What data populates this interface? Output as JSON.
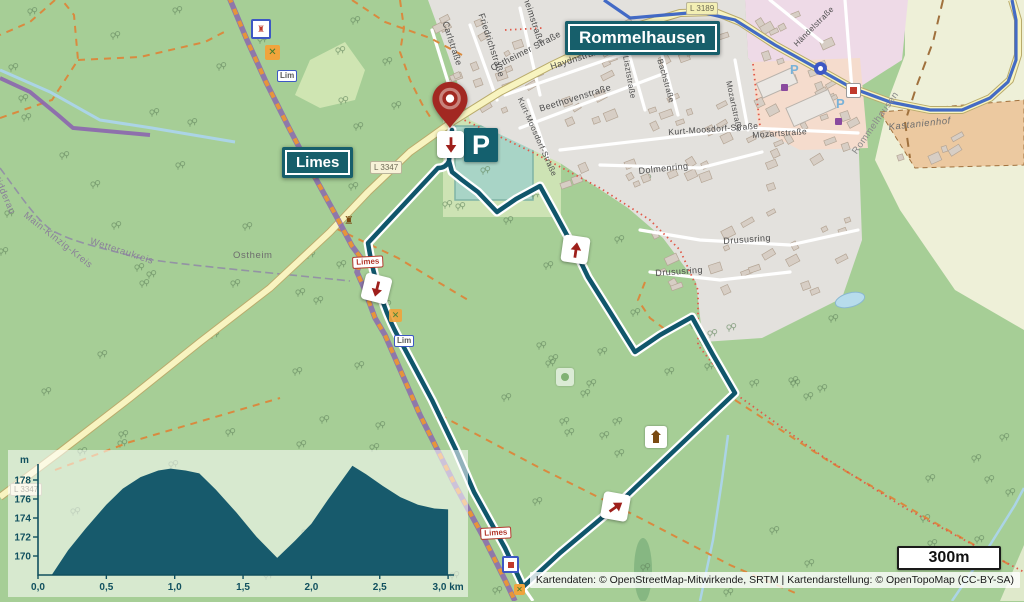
{
  "map": {
    "labels": {
      "town": "Rommelhausen",
      "trail": "Limes"
    },
    "road_badges": {
      "l3347": "L 3347",
      "l3189": "L 3189"
    },
    "trail_badges": {
      "limes": "Limes",
      "lim": "Lim"
    },
    "parking": "P",
    "streets": [
      "Ostheimer Straße",
      "Carlstraße",
      "Friedrichstraße",
      "heimstraße",
      "Haydnstraße",
      "Beethovenstraße",
      "Kurt-Moosdorf-Straße",
      "Kurt-Moosdorf-Straße",
      "Mozartstraße",
      "Mozartstraße",
      "Lisztstraße",
      "Bachstraße",
      "Dolmenring",
      "Drususring",
      "Drususring",
      "Händelstraße"
    ],
    "places": [
      "Ostheim",
      "Nidderau",
      "Main-Kinzig-Kreis",
      "Wetteraukreis",
      "Kastanienhof",
      "Rommelhausen"
    ],
    "small_parking_labels": [
      "P",
      "P"
    ],
    "scale_label": "300m",
    "attribution": "Kartendaten: © OpenStreetMap-Mitwirkende, SRTM | Kartendarstellung: © OpenTopoMap (CC-BY-SA)",
    "colors": {
      "route": "#10566b",
      "label_box": "#175f6b",
      "marker_red": "#9e211c",
      "cycle_route": "#3a63c4",
      "forest": "#a6ce96",
      "limes_path": "#8a68ae",
      "limes_dash": "#e6953a"
    }
  },
  "chart_data": {
    "type": "area",
    "title": "",
    "xlabel": "km",
    "ylabel": "m",
    "xlim": [
      0,
      3
    ],
    "ylim": [
      168,
      180
    ],
    "grid": false,
    "x_ticks": [
      {
        "v": 0,
        "label": "0,0"
      },
      {
        "v": 0.5,
        "label": "0,5"
      },
      {
        "v": 1,
        "label": "1,0"
      },
      {
        "v": 1.5,
        "label": "1,5"
      },
      {
        "v": 2,
        "label": "2,0"
      },
      {
        "v": 2.5,
        "label": "2,5"
      },
      {
        "v": 3,
        "label": "3,0 km"
      }
    ],
    "y_ticks": [
      170,
      172,
      174,
      176,
      178
    ],
    "series": [
      {
        "name": "elevation_profile",
        "color": "#175a6c",
        "points": [
          [
            0.1,
            168.0
          ],
          [
            0.22,
            170.6
          ],
          [
            0.35,
            172.9
          ],
          [
            0.5,
            175.4
          ],
          [
            0.62,
            177.1
          ],
          [
            0.75,
            178.3
          ],
          [
            0.88,
            179.0
          ],
          [
            0.97,
            179.2
          ],
          [
            1.08,
            179.0
          ],
          [
            1.18,
            178.7
          ],
          [
            1.3,
            177.0
          ],
          [
            1.45,
            174.6
          ],
          [
            1.6,
            172.0
          ],
          [
            1.75,
            169.8
          ],
          [
            1.88,
            171.6
          ],
          [
            2.0,
            173.4
          ],
          [
            2.12,
            175.9
          ],
          [
            2.22,
            177.9
          ],
          [
            2.3,
            179.5
          ],
          [
            2.4,
            178.6
          ],
          [
            2.52,
            177.4
          ],
          [
            2.65,
            176.2
          ],
          [
            2.78,
            175.4
          ],
          [
            2.9,
            175.0
          ],
          [
            3.0,
            174.9
          ]
        ]
      }
    ]
  }
}
